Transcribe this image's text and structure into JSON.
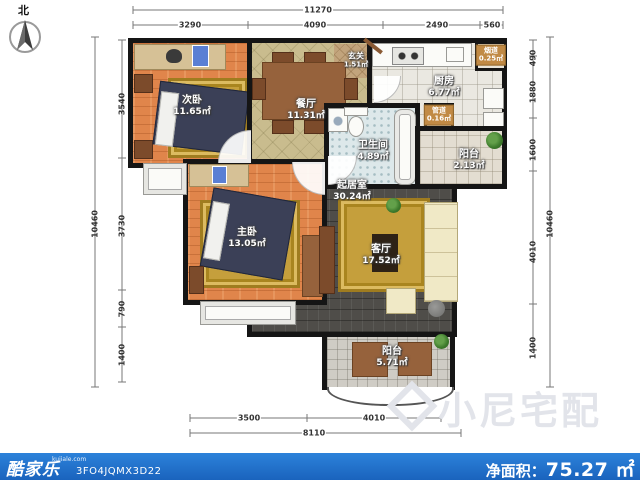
{
  "compass": {
    "north_label": "北"
  },
  "rooms": {
    "ciwo": {
      "name": "次卧",
      "area": "11.65㎡"
    },
    "zhuwo": {
      "name": "主卧",
      "area": "13.05㎡"
    },
    "canting": {
      "name": "餐厅",
      "area": "11.31㎡"
    },
    "xuanguan": {
      "name": "玄关",
      "area": "1.51㎡"
    },
    "chufang": {
      "name": "厨房",
      "area": "6.77㎡"
    },
    "weishengjian": {
      "name": "卫生间",
      "area": "4.89㎡"
    },
    "yangtai_right": {
      "name": "阳台",
      "area": "2.13㎡"
    },
    "qijushi": {
      "name": "起居室",
      "area": "30.24㎡"
    },
    "keting": {
      "name": "客厅",
      "area": "17.52㎡"
    },
    "yangtai_bottom": {
      "name": "阳台",
      "area": "5.71㎡"
    },
    "yandao": {
      "name": "烟道",
      "area": "0.25㎡"
    },
    "guandao": {
      "name": "管道",
      "area": "0.16㎡"
    }
  },
  "dims": {
    "top_total": "11270",
    "top": [
      "3290",
      "4090",
      "2490",
      "560"
    ],
    "left_total": "10460",
    "left": [
      "3540",
      "3730",
      "790",
      "1400"
    ],
    "right_total": "10460",
    "right": [
      "490",
      "1880",
      "1600",
      "4010",
      "1400"
    ],
    "bottom": [
      "3500",
      "4010"
    ],
    "bottom_total": "8110"
  },
  "watermark": {
    "text": "小尼宅配"
  },
  "footer": {
    "brand": "酷家乐",
    "domain": "kujiale.com",
    "plan_id": "3FO4JQMX3D22",
    "net_area_label": "净面积：",
    "net_area_value": "75.27",
    "net_area_unit": "㎡"
  },
  "colors": {
    "footer_blue": "#1e6ec8",
    "wall": "#151515",
    "wood_floor": "#e0854b",
    "dark_floor": "#4f4d49"
  }
}
